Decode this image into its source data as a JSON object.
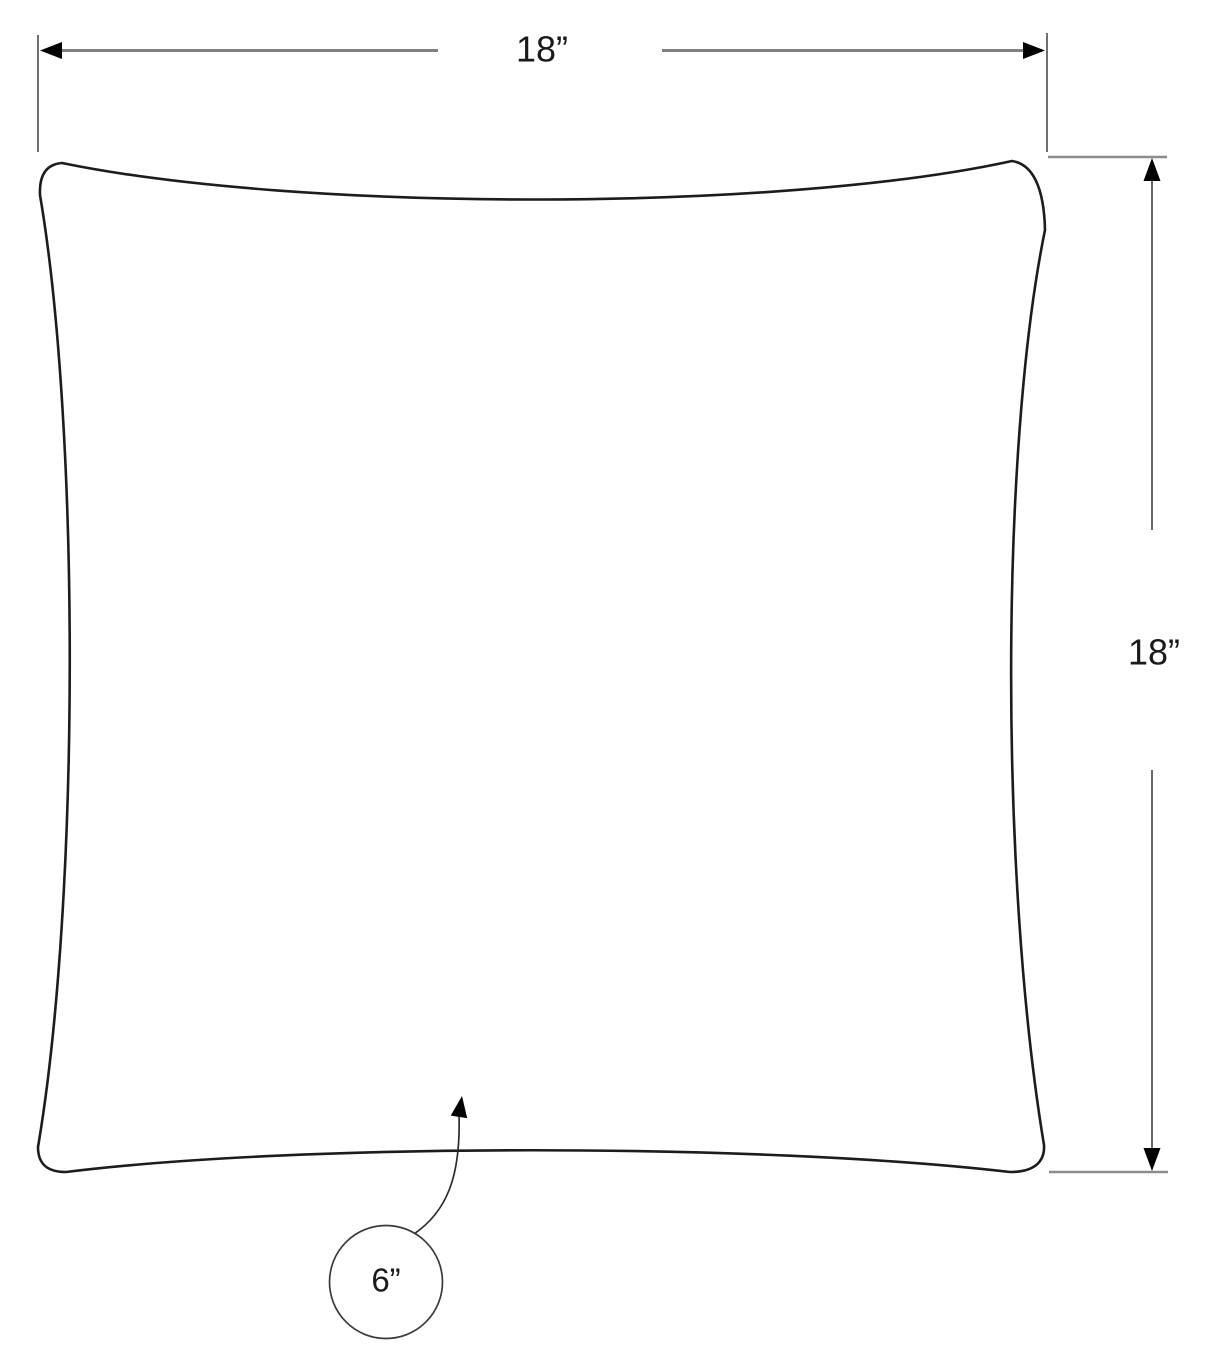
{
  "drawing": {
    "subject": "pillow-top-view-dimension-drawing",
    "labels": {
      "width": "18”",
      "height": "18”",
      "detail": "6”"
    },
    "colors": {
      "outline": "#1c1c1c",
      "dimension_line": "#808080",
      "extension_line_dark": "#4d4d4d",
      "extension_line_light": "#8c8c8c",
      "arrowhead": "#000000",
      "leader_line": "#2b2b2b",
      "detail_circle": "#3a3a3a",
      "text": "#1a1a1a",
      "background": "#ffffff"
    }
  }
}
